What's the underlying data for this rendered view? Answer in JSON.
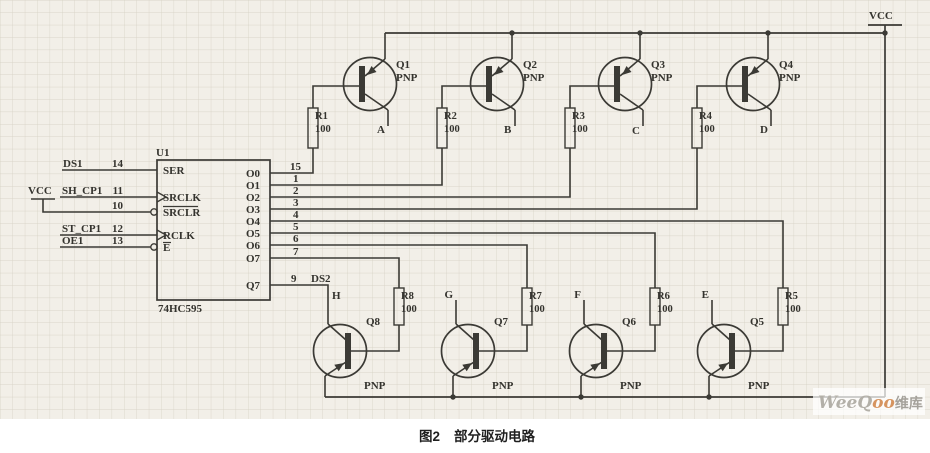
{
  "ic": {
    "designator": "U1",
    "part": "74HC595",
    "left_pins": [
      {
        "name": "SER",
        "number": "14",
        "net": "DS1"
      },
      {
        "name": "SRCLK",
        "number": "11",
        "net": "SH_CP1"
      },
      {
        "name": "SRCLR",
        "number": "10",
        "net": "VCC"
      },
      {
        "name": "RCLK",
        "number": "12",
        "net": "ST_CP1"
      },
      {
        "name": "E",
        "number": "13",
        "net": "OE1"
      }
    ],
    "right_pins": [
      {
        "name": "O0",
        "number": "15"
      },
      {
        "name": "O1",
        "number": "1"
      },
      {
        "name": "O2",
        "number": "2"
      },
      {
        "name": "O3",
        "number": "3"
      },
      {
        "name": "O4",
        "number": "4"
      },
      {
        "name": "O5",
        "number": "5"
      },
      {
        "name": "O6",
        "number": "6"
      },
      {
        "name": "O7",
        "number": "7"
      },
      {
        "name": "Q7",
        "number": "9",
        "net": "DS2"
      }
    ]
  },
  "transistors": {
    "top": [
      {
        "designator": "Q1",
        "type": "PNP",
        "output": "A"
      },
      {
        "designator": "Q2",
        "type": "PNP",
        "output": "B"
      },
      {
        "designator": "Q3",
        "type": "PNP",
        "output": "C"
      },
      {
        "designator": "Q4",
        "type": "PNP",
        "output": "D"
      }
    ],
    "bottom": [
      {
        "designator": "Q8",
        "type": "PNP",
        "output": "H"
      },
      {
        "designator": "Q7",
        "type": "PNP",
        "output": "G"
      },
      {
        "designator": "Q6",
        "type": "PNP",
        "output": "F"
      },
      {
        "designator": "Q5",
        "type": "PNP",
        "output": "E"
      }
    ]
  },
  "resistors": {
    "top": [
      {
        "designator": "R1",
        "value": "100"
      },
      {
        "designator": "R2",
        "value": "100"
      },
      {
        "designator": "R3",
        "value": "100"
      },
      {
        "designator": "R4",
        "value": "100"
      }
    ],
    "bottom": [
      {
        "designator": "R8",
        "value": "100"
      },
      {
        "designator": "R7",
        "value": "100"
      },
      {
        "designator": "R6",
        "value": "100"
      },
      {
        "designator": "R5",
        "value": "100"
      }
    ]
  },
  "power": {
    "vcc": "VCC"
  },
  "caption": {
    "figure": "图2",
    "title": "部分驱动电路"
  },
  "watermark": {
    "latin": "WeeQ",
    "latin_accent": "oo",
    "cjk": "维库"
  },
  "colors": {
    "ink": "#3b3a35",
    "paper": "#f2efe8",
    "grid": "#c8c3b2",
    "ic_fill": "#fbfaf6",
    "watermark_accent": "#d6945f"
  }
}
